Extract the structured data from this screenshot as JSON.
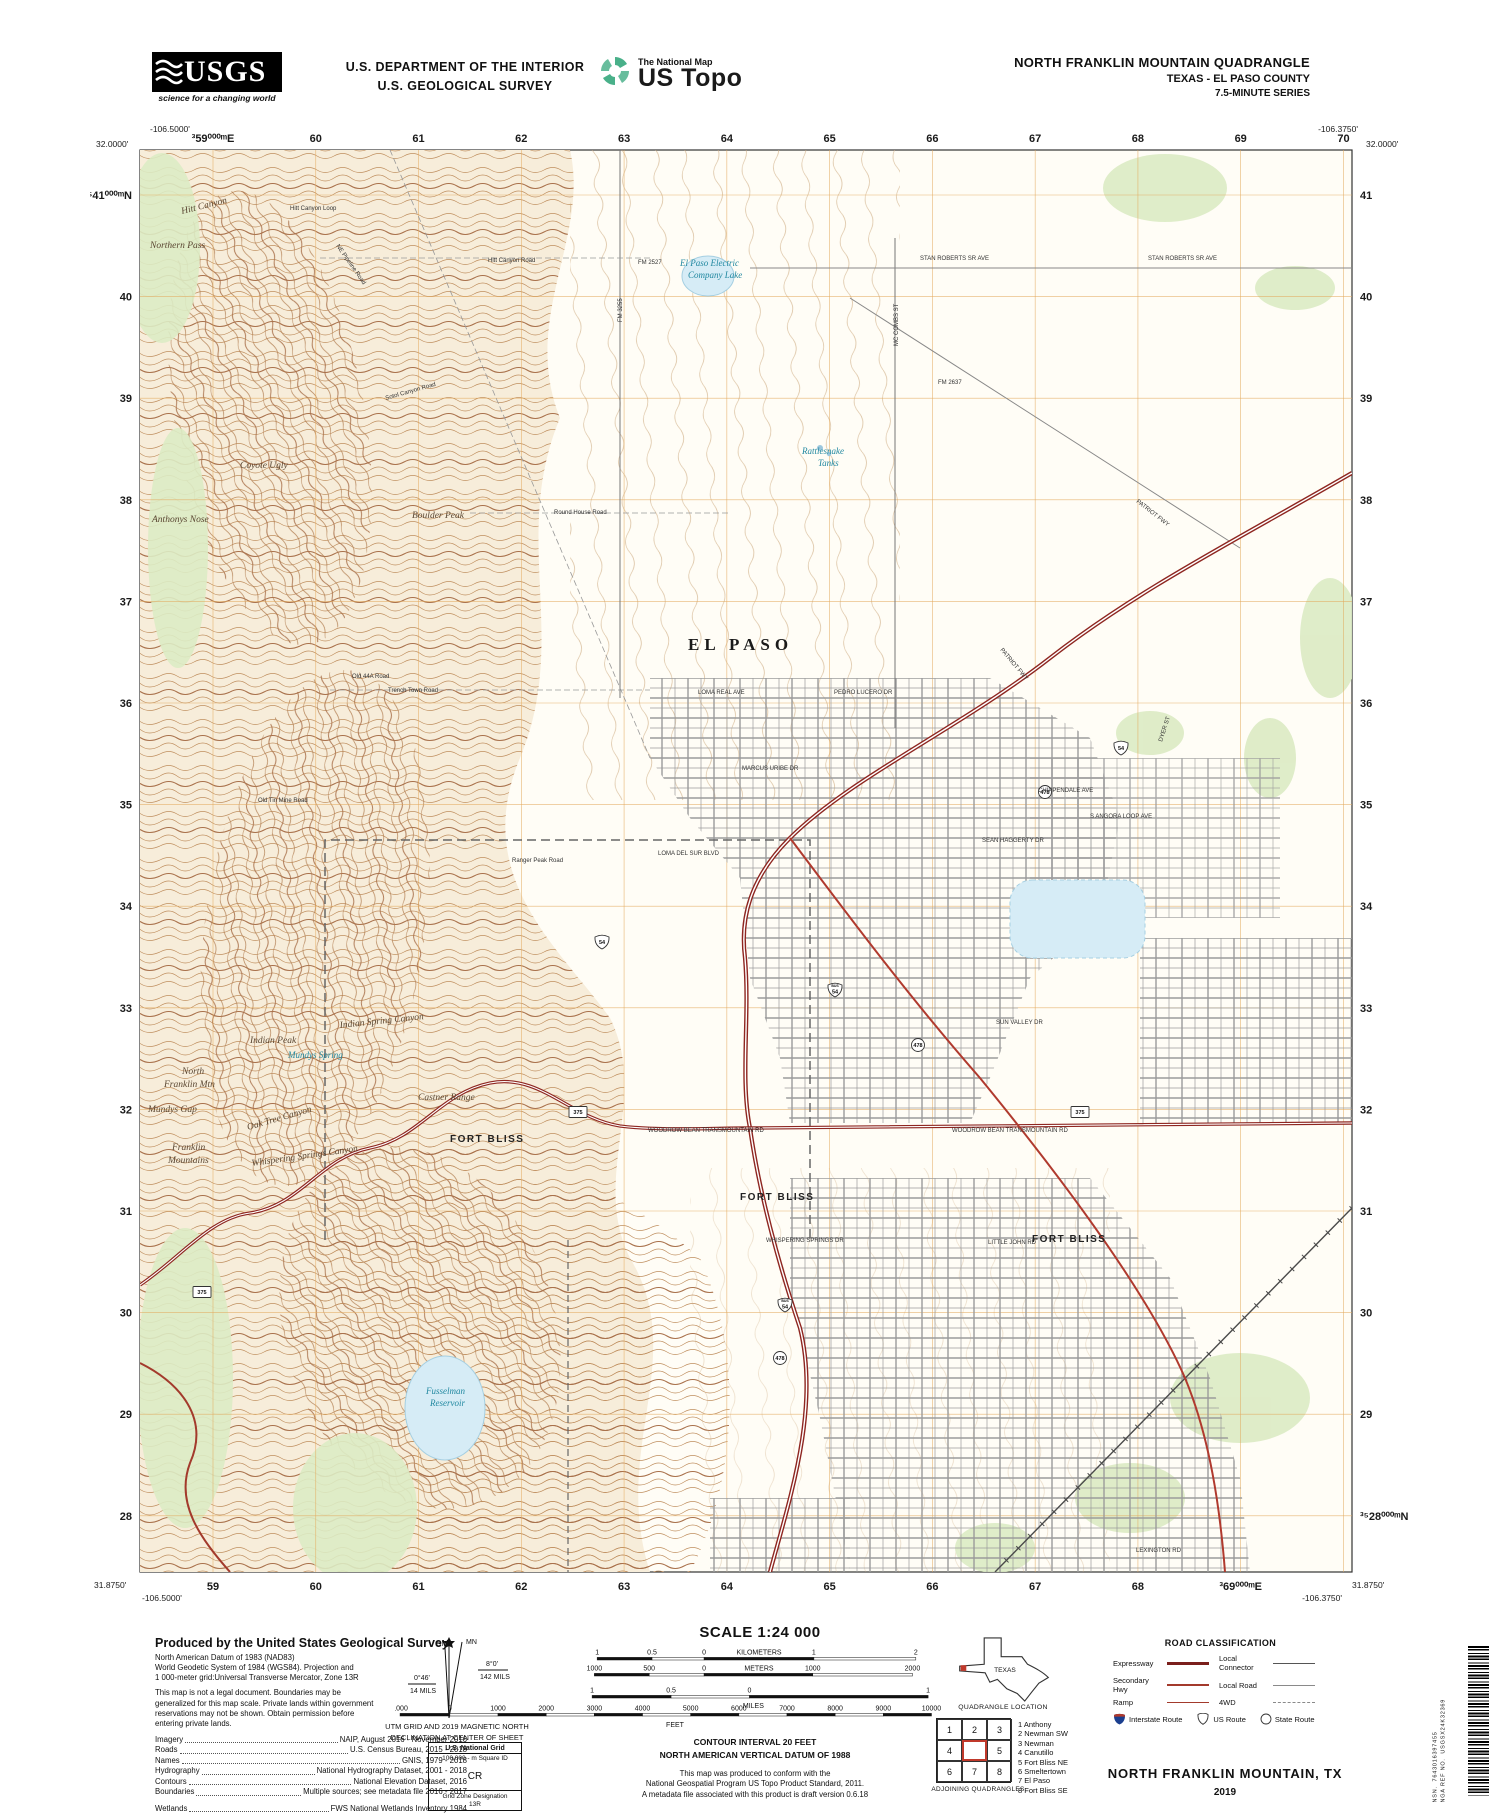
{
  "header": {
    "usgs_word": "USGS",
    "usgs_tagline": "science for a changing world",
    "dept": [
      "U.S. DEPARTMENT OF THE INTERIOR",
      "U.S. GEOLOGICAL SURVEY"
    ],
    "ustopo": {
      "brand": "The National Map",
      "product": "US Topo"
    },
    "title": {
      "line1": "NORTH FRANKLIN MOUNTAIN QUADRANGLE",
      "line2": "TEXAS - EL PASO COUNTY",
      "line3": "7.5-MINUTE SERIES"
    }
  },
  "map": {
    "corners": {
      "top_left": {
        "lon": "-106.5000'",
        "lat": "32.0000'"
      },
      "top_right": {
        "lon": "-106.3750'",
        "lat": "32.0000'"
      },
      "bottom_left": {
        "lat": "31.8750'",
        "lon": "-106.5000'"
      },
      "bottom_right": {
        "lon": "-106.3750'",
        "lat": "31.8750'"
      }
    },
    "grid": {
      "eastings_top": [
        "³59⁰⁰⁰ᵐE",
        "60",
        "61",
        "62",
        "63",
        "64",
        "65",
        "66",
        "67",
        "68",
        "69",
        "70"
      ],
      "eastings_bottom": [
        "59",
        "60",
        "61",
        "62",
        "63",
        "64",
        "65",
        "66",
        "67",
        "68",
        "³69⁰⁰⁰ᵐE"
      ],
      "northings_left": [
        "³⁵41⁰⁰⁰ᵐN",
        "40",
        "39",
        "38",
        "37",
        "36",
        "35",
        "34",
        "33",
        "32",
        "31",
        "30",
        "29",
        "28"
      ],
      "northings_right": [
        "41",
        "40",
        "39",
        "38",
        "37",
        "36",
        "35",
        "34",
        "33",
        "32",
        "31",
        "30",
        "29",
        "³⁵28⁰⁰⁰ᵐN"
      ]
    },
    "labels": [
      {
        "t": "EL PASO",
        "x": 548,
        "y": 500,
        "c": "city"
      },
      {
        "t": "FORT BLISS",
        "x": 310,
        "y": 992,
        "c": "mil"
      },
      {
        "t": "FORT BLISS",
        "x": 600,
        "y": 1050,
        "c": "mil"
      },
      {
        "t": "FORT BLISS",
        "x": 892,
        "y": 1092,
        "c": "mil"
      },
      {
        "t": "Hitt Canyon",
        "x": 42,
        "y": 64,
        "c": "nat",
        "r": -14
      },
      {
        "t": "Northern Pass",
        "x": 10,
        "y": 98,
        "c": "nat"
      },
      {
        "t": "Anthonys Nose",
        "x": 12,
        "y": 372,
        "c": "nat"
      },
      {
        "t": "Coyote Ugly",
        "x": 100,
        "y": 318,
        "c": "nat"
      },
      {
        "t": "Boulder Peak",
        "x": 272,
        "y": 368,
        "c": "nat"
      },
      {
        "t": "Mundys Gap",
        "x": 8,
        "y": 962,
        "c": "nat"
      },
      {
        "t": "Franklin",
        "x": 32,
        "y": 1000,
        "c": "nat"
      },
      {
        "t": "Mountains",
        "x": 28,
        "y": 1013,
        "c": "nat"
      },
      {
        "t": "North",
        "x": 42,
        "y": 924,
        "c": "nat"
      },
      {
        "t": "Franklin Mtn",
        "x": 24,
        "y": 937,
        "c": "nat"
      },
      {
        "t": "Indian Peak",
        "x": 110,
        "y": 893,
        "c": "nat"
      },
      {
        "t": "Indian Spring Canyon",
        "x": 200,
        "y": 878,
        "c": "nat",
        "r": -6
      },
      {
        "t": "Castner Range",
        "x": 278,
        "y": 950,
        "c": "nat"
      },
      {
        "t": "Oak Tree Canyon",
        "x": 108,
        "y": 980,
        "c": "nat",
        "r": -16
      },
      {
        "t": "Whispering Springs Canyon",
        "x": 112,
        "y": 1016,
        "c": "nat",
        "r": -8
      },
      {
        "t": "Mundys Spring",
        "x": 148,
        "y": 908,
        "c": "wat"
      },
      {
        "t": "El Paso Electric",
        "x": 540,
        "y": 116,
        "c": "wat"
      },
      {
        "t": "Company Lake",
        "x": 548,
        "y": 128,
        "c": "wat"
      },
      {
        "t": "Rattlesnake",
        "x": 662,
        "y": 304,
        "c": "wat"
      },
      {
        "t": "Tanks",
        "x": 678,
        "y": 316,
        "c": "wat"
      },
      {
        "t": "Fusselman",
        "x": 286,
        "y": 1244,
        "c": "wat"
      },
      {
        "t": "Reservoir",
        "x": 290,
        "y": 1256,
        "c": "wat"
      },
      {
        "t": "NE Pipeline Road",
        "x": 196,
        "y": 96,
        "c": "rd",
        "r": 55
      },
      {
        "t": "Hitt Canyon Road",
        "x": 348,
        "y": 112,
        "c": "rd"
      },
      {
        "t": "Hitt Canyon Loop",
        "x": 150,
        "y": 60,
        "c": "rd"
      },
      {
        "t": "Sotol Canyon Road",
        "x": 246,
        "y": 250,
        "c": "rd",
        "r": -16
      },
      {
        "t": "Round House Road",
        "x": 414,
        "y": 364,
        "c": "rd"
      },
      {
        "t": "Trench Town Road",
        "x": 248,
        "y": 542,
        "c": "rd"
      },
      {
        "t": "Old 44A Road",
        "x": 212,
        "y": 528,
        "c": "rd"
      },
      {
        "t": "Old Tin Mine Road",
        "x": 118,
        "y": 652,
        "c": "rd"
      },
      {
        "t": "Ranger Peak Road",
        "x": 372,
        "y": 712,
        "c": "rd"
      },
      {
        "t": "FM 3255",
        "x": 482,
        "y": 172,
        "c": "rd",
        "r": -90
      },
      {
        "t": "FM 2527",
        "x": 498,
        "y": 114,
        "c": "rd"
      },
      {
        "t": "FM 2637",
        "x": 798,
        "y": 234,
        "c": "rd"
      },
      {
        "t": "STAN ROBERTS SR AVE",
        "x": 780,
        "y": 110,
        "c": "rd"
      },
      {
        "t": "STAN ROBERTS SR AVE",
        "x": 1008,
        "y": 110,
        "c": "rd"
      },
      {
        "t": "MC COMBS ST",
        "x": 758,
        "y": 196,
        "c": "rd",
        "r": -90
      },
      {
        "t": "PATRIOT FWY",
        "x": 996,
        "y": 352,
        "c": "rd",
        "r": 38
      },
      {
        "t": "PATRIOT FWY",
        "x": 860,
        "y": 500,
        "c": "rd",
        "r": 50
      },
      {
        "t": "DYER ST",
        "x": 1022,
        "y": 592,
        "c": "rd",
        "r": -72
      },
      {
        "t": "LOMA REAL AVE",
        "x": 558,
        "y": 544,
        "c": "rd"
      },
      {
        "t": "PEDRO LUCERO DR",
        "x": 694,
        "y": 544,
        "c": "rd"
      },
      {
        "t": "MARCUS URIBE DR",
        "x": 602,
        "y": 620,
        "c": "rd"
      },
      {
        "t": "SEAN HAGGERTY DR",
        "x": 842,
        "y": 692,
        "c": "rd"
      },
      {
        "t": "S ANGORA LOOP AVE",
        "x": 950,
        "y": 668,
        "c": "rd"
      },
      {
        "t": "CHIPPENDALE AVE",
        "x": 898,
        "y": 642,
        "c": "rd"
      },
      {
        "t": "LOMA DEL SUR BLVD",
        "x": 518,
        "y": 705,
        "c": "rd"
      },
      {
        "t": "SUN VALLEY DR",
        "x": 856,
        "y": 874,
        "c": "rd"
      },
      {
        "t": "WOODROW BEAN TRANSMOUNTAIN RD",
        "x": 508,
        "y": 982,
        "c": "rd"
      },
      {
        "t": "WOODROW BEAN TRANSMOUNTAIN RD",
        "x": 812,
        "y": 982,
        "c": "rd"
      },
      {
        "t": "WHISPERING SPRINGS DR",
        "x": 626,
        "y": 1092,
        "c": "rd"
      },
      {
        "t": "LITTLE JOHN RD",
        "x": 848,
        "y": 1094,
        "c": "rd"
      },
      {
        "t": "LEXINGTON RD",
        "x": 996,
        "y": 1402,
        "c": "rd"
      }
    ],
    "routes": [
      {
        "k": "us",
        "t": "54",
        "x": 981,
        "y": 598
      },
      {
        "k": "us",
        "t": "54",
        "x": 462,
        "y": 792
      },
      {
        "k": "bus",
        "t": "54",
        "x": 695,
        "y": 840
      },
      {
        "k": "bus",
        "t": "54",
        "x": 645,
        "y": 1155
      },
      {
        "k": "c",
        "t": "478",
        "x": 905,
        "y": 642
      },
      {
        "k": "c",
        "t": "478",
        "x": 778,
        "y": 895
      },
      {
        "k": "c",
        "t": "478",
        "x": 640,
        "y": 1208
      },
      {
        "k": "b",
        "t": "375",
        "x": 438,
        "y": 962
      },
      {
        "k": "b",
        "t": "375",
        "x": 940,
        "y": 962
      },
      {
        "k": "b",
        "t": "375",
        "x": 62,
        "y": 1142
      }
    ]
  },
  "footer": {
    "produced": {
      "title": "Produced by the United States Geological Survey",
      "datum_lines": [
        "North American Datum of 1983 (NAD83)",
        "World Geodetic System of 1984 (WGS84).  Projection and",
        "1 000-meter grid:Universal Transverse Mercator, Zone 13R"
      ],
      "legal_lines": [
        "This map is not a legal document. Boundaries may be",
        "generalized for this map scale. Private lands within government",
        "reservations may not be shown. Obtain permission before",
        "entering private lands."
      ],
      "credits": [
        {
          "k": "Imagery",
          "v": "NAIP, August 2016 - November 2016"
        },
        {
          "k": "Roads",
          "v": "U.S. Census Bureau, 2015 - 2018"
        },
        {
          "k": "Names",
          "v": "GNIS, 1979 - 2018"
        },
        {
          "k": "Hydrography",
          "v": "National Hydrography Dataset, 2001 - 2018"
        },
        {
          "k": "Contours",
          "v": "National Elevation Dataset, 2016"
        },
        {
          "k": "Boundaries",
          "v": "Multiple sources; see metadata file 2016 - 2017"
        },
        {
          "k": "Wetlands",
          "v": "FWS National Wetlands Inventory 1984"
        }
      ]
    },
    "declination": {
      "mn": "MN",
      "gn": "GN",
      "mn_deg": "8°0'",
      "mn_mils": "142 MILS",
      "gn_deg": "0°46'",
      "gn_mils": "14 MILS",
      "caption": [
        "UTM GRID AND 2019 MAGNETIC NORTH",
        "DECLINATION AT CENTER OF SHEET"
      ]
    },
    "usng": {
      "title": "U.S. National Grid",
      "square_label": "100,000 - m Square ID",
      "square_id": "CR",
      "zone_label": "Grid Zone Designation",
      "zone": "13R"
    },
    "scale": {
      "title": "SCALE 1:24 000",
      "bars": [
        {
          "unit": "KILOMETERS",
          "labels": [
            "1",
            "0.5",
            "0",
            "1",
            "2"
          ]
        },
        {
          "unit": "METERS",
          "labels": [
            "1000",
            "500",
            "0",
            "1000",
            "2000"
          ]
        },
        {
          "unit": "MILES",
          "labels": [
            "1",
            "0.5",
            "0",
            "1"
          ]
        },
        {
          "unit": "FEET",
          "labels": [
            "1000",
            "0",
            "1000",
            "2000",
            "3000",
            "4000",
            "5000",
            "6000",
            "7000",
            "8000",
            "9000",
            "10000"
          ]
        }
      ]
    },
    "notes": {
      "contour": "CONTOUR INTERVAL 20 FEET",
      "vdatum": "NORTH AMERICAN VERTICAL DATUM OF 1988",
      "conform": [
        "This map was produced to conform with the",
        "National Geospatial Program US Topo Product Standard, 2011.",
        "A metadata file associated with this product is draft version 0.6.18"
      ]
    },
    "quadloc": {
      "state": "TEXAS",
      "caption": "QUADRANGLE LOCATION"
    },
    "adjoining": {
      "cells": [
        "1",
        "2",
        "3",
        "4",
        "",
        "5",
        "6",
        "7",
        "8"
      ],
      "names": [
        "1 Anthony",
        "2 Newman SW",
        "3 Newman",
        "4 Canutillo",
        "5 Fort Bliss NE",
        "6 Smeltertown",
        "7 El Paso",
        "8 Fort Bliss SE"
      ],
      "caption": "ADJOINING QUADRANGLES"
    },
    "road_class": {
      "title": "ROAD CLASSIFICATION",
      "items": [
        {
          "label": "Expressway"
        },
        {
          "label": "Secondary Hwy"
        },
        {
          "label": "Ramp"
        },
        {
          "label": "Local Connector"
        },
        {
          "label": "Local Road"
        },
        {
          "label": "4WD"
        }
      ],
      "shields": [
        {
          "label": "Interstate Route"
        },
        {
          "label": "US Route"
        },
        {
          "label": "State Route"
        }
      ]
    },
    "mapname": {
      "name": "NORTH FRANKLIN MOUNTAIN,  TX",
      "year": "2019"
    },
    "barcode": {
      "nsn_label": "NSN.",
      "nsn": "7643016397455",
      "nga_label": "NGA REF NO.",
      "nga": "USGSX24K32369"
    }
  },
  "colors": {
    "contour": "#bf8e5e",
    "contour_index": "#a9714b",
    "terrain": "#f7edda",
    "vegetation": "#dcebc4",
    "water_fill": "#d6ecf6",
    "water_line": "#a5cfe2",
    "grid": "#e3a95c",
    "expressway": "#8e2620",
    "secondary": "#a33a2c",
    "street": "#9b9b9b",
    "water_label": "#2188a0"
  }
}
